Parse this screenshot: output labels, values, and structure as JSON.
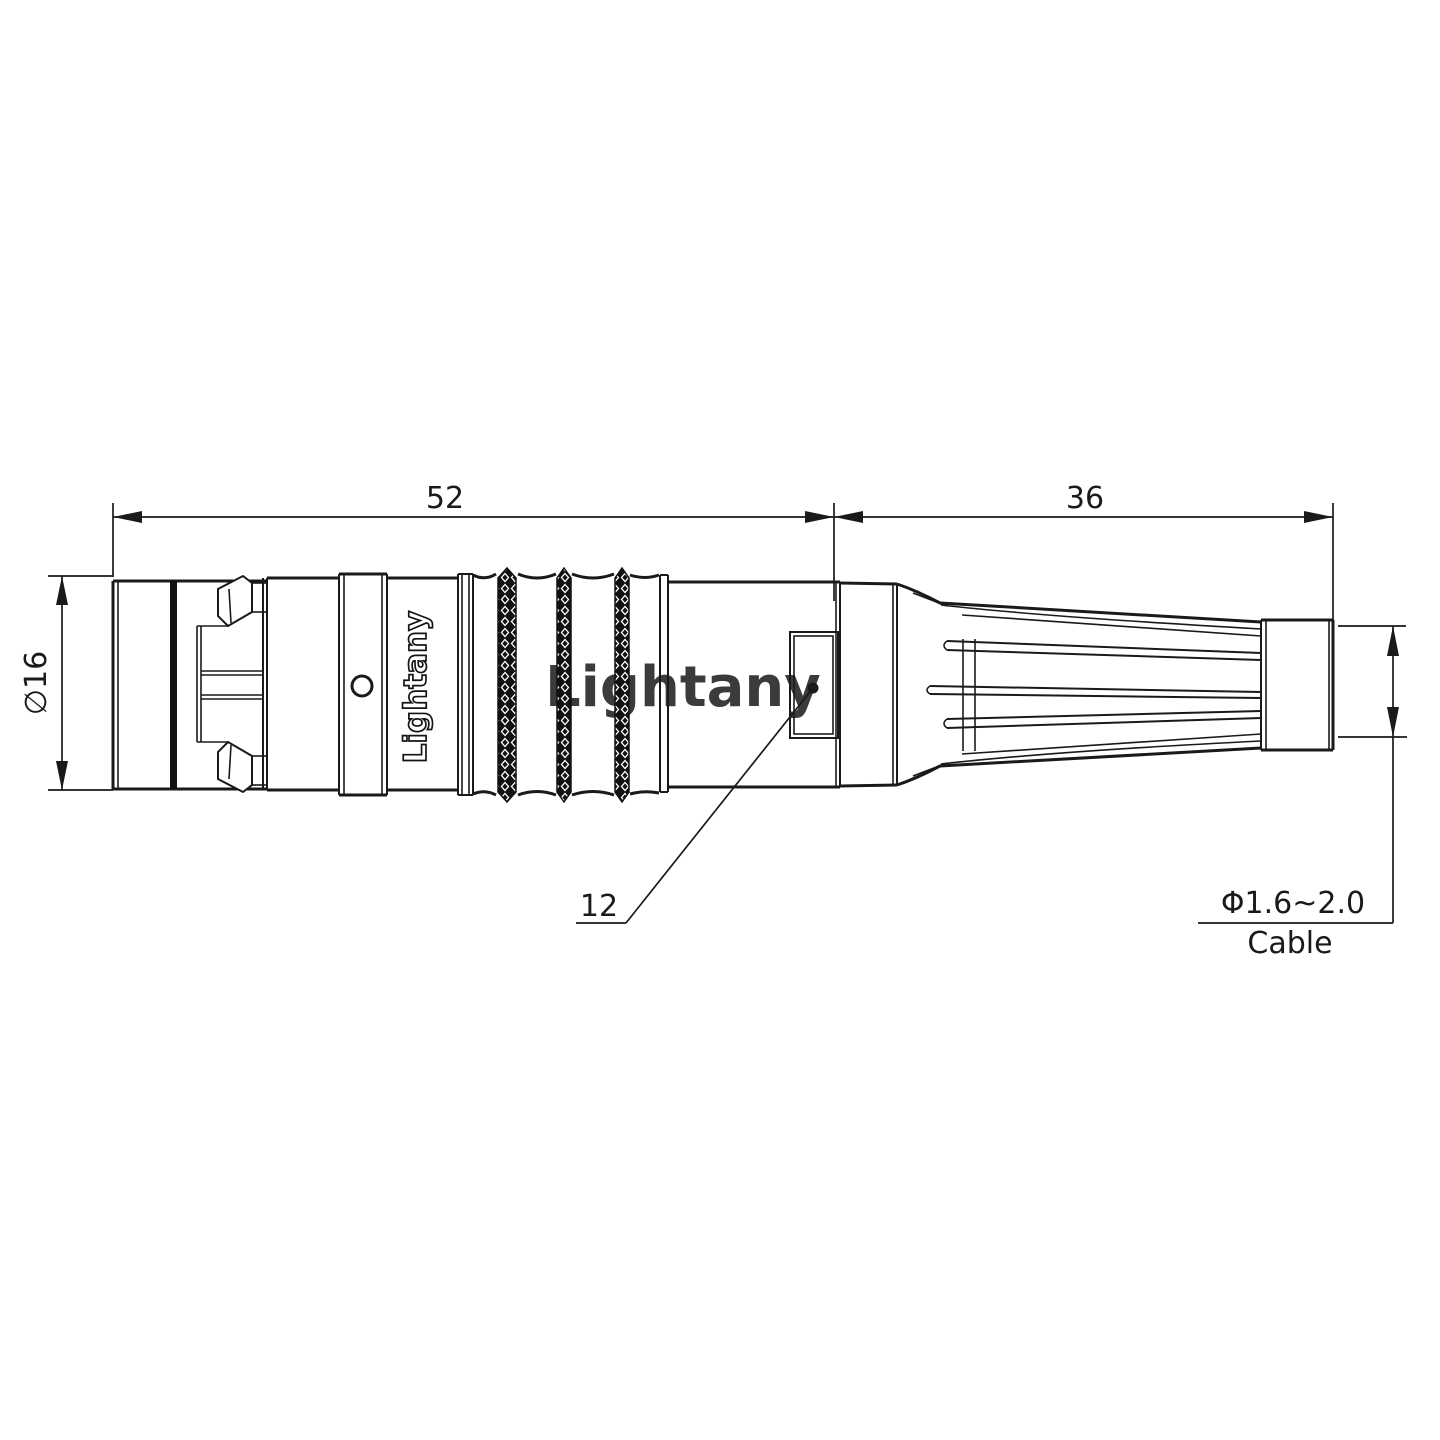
{
  "page": {
    "background": "#ffffff"
  },
  "drawing": {
    "dimensions": {
      "length_front": "52",
      "length_back": "36",
      "outer_diameter": "∅16",
      "mid_diameter": "12",
      "cable_diameter": "Φ1.6~2.0",
      "cable_label": "Cable"
    },
    "branding": {
      "body_marking": "Lightany",
      "watermark": "Lightany"
    },
    "colors": {
      "line": "#1a1a1a",
      "watermark": "#f2c0c0"
    }
  }
}
